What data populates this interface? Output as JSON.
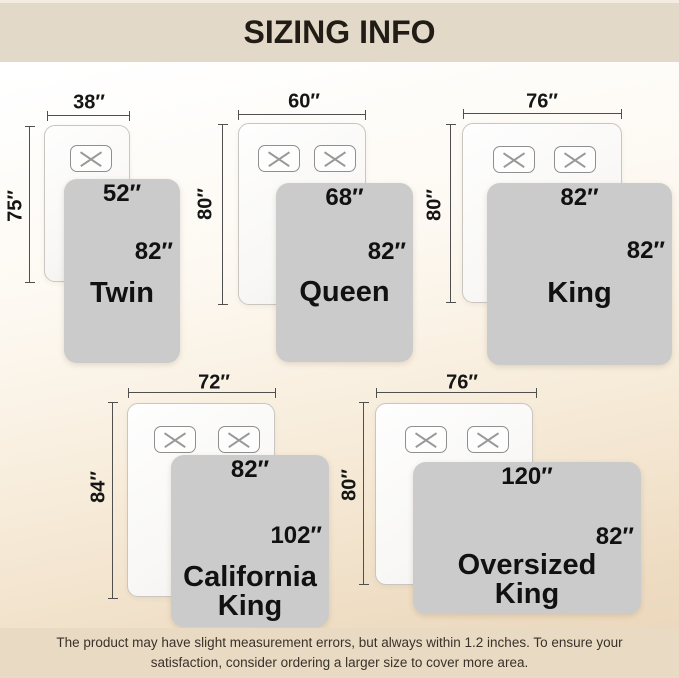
{
  "header": {
    "title": "SIZING INFO"
  },
  "beds": [
    {
      "id": "twin",
      "name": "Twin",
      "mattress_width": "38″",
      "mattress_height": "75″",
      "blanket_width": "52″",
      "blanket_height": "82″",
      "pillows": 1
    },
    {
      "id": "queen",
      "name": "Queen",
      "mattress_width": "60″",
      "mattress_height": "80″",
      "blanket_width": "68″",
      "blanket_height": "82″",
      "pillows": 2
    },
    {
      "id": "king",
      "name": "King",
      "mattress_width": "76″",
      "mattress_height": "80″",
      "blanket_width": "82″",
      "blanket_height": "82″",
      "pillows": 2
    },
    {
      "id": "california-king",
      "name": "California\nKing",
      "mattress_width": "72″",
      "mattress_height": "84″",
      "blanket_width": "82″",
      "blanket_height": "102″",
      "pillows": 2
    },
    {
      "id": "oversized-king",
      "name": "Oversized\nKing",
      "mattress_width": "76″",
      "mattress_height": "80″",
      "blanket_width": "120″",
      "blanket_height": "82″",
      "pillows": 2
    }
  ],
  "footer": {
    "line1": "The product may have slight measurement errors, but always within 1.2 inches. To ensure your",
    "line2": "satisfaction, consider ordering a larger size to cover more area."
  },
  "colors": {
    "band_beige": "#e3d9c8",
    "footer_beige": "#e9dac3",
    "blanket_gray": "#cbcbcb",
    "text_dark": "#111111",
    "dimension_line": "#4f4f4f"
  }
}
